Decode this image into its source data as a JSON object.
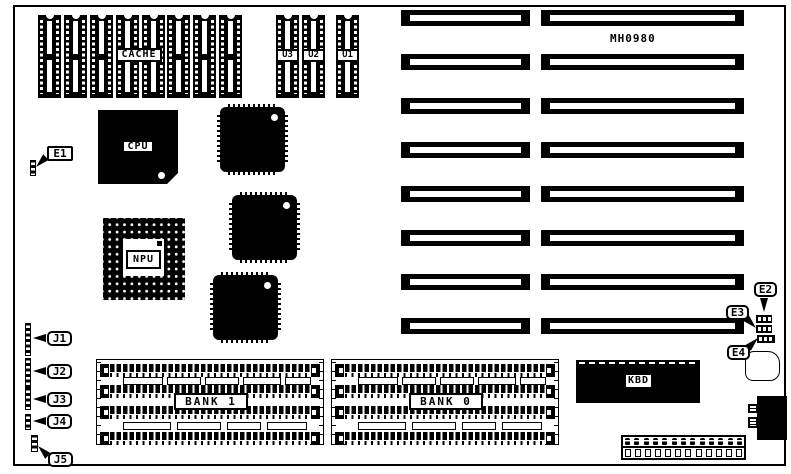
{
  "board": {
    "model": "MH0980",
    "cache_label": "CACHE",
    "cache_socket_count": 8,
    "u_sockets": [
      {
        "label": "U3"
      },
      {
        "label": "U2"
      },
      {
        "label": "U1"
      }
    ],
    "cpu_label": "CPU",
    "npu_label": "NPU",
    "kbd_label": "KBD",
    "banks": [
      {
        "label": "BANK 1",
        "simm_rows": 4
      },
      {
        "label": "BANK 0",
        "simm_rows": 4
      }
    ],
    "jumpers": [
      {
        "label": "E1"
      },
      {
        "label": "E2"
      },
      {
        "label": "E3"
      },
      {
        "label": "E4"
      }
    ],
    "headers": [
      {
        "label": "J1"
      },
      {
        "label": "J2"
      },
      {
        "label": "J3"
      },
      {
        "label": "J4"
      },
      {
        "label": "J5"
      }
    ],
    "expansion_slots": {
      "count": 8,
      "segments_per_slot": 2
    }
  },
  "colors": {
    "ink": "#000000",
    "paper": "#ffffff"
  }
}
